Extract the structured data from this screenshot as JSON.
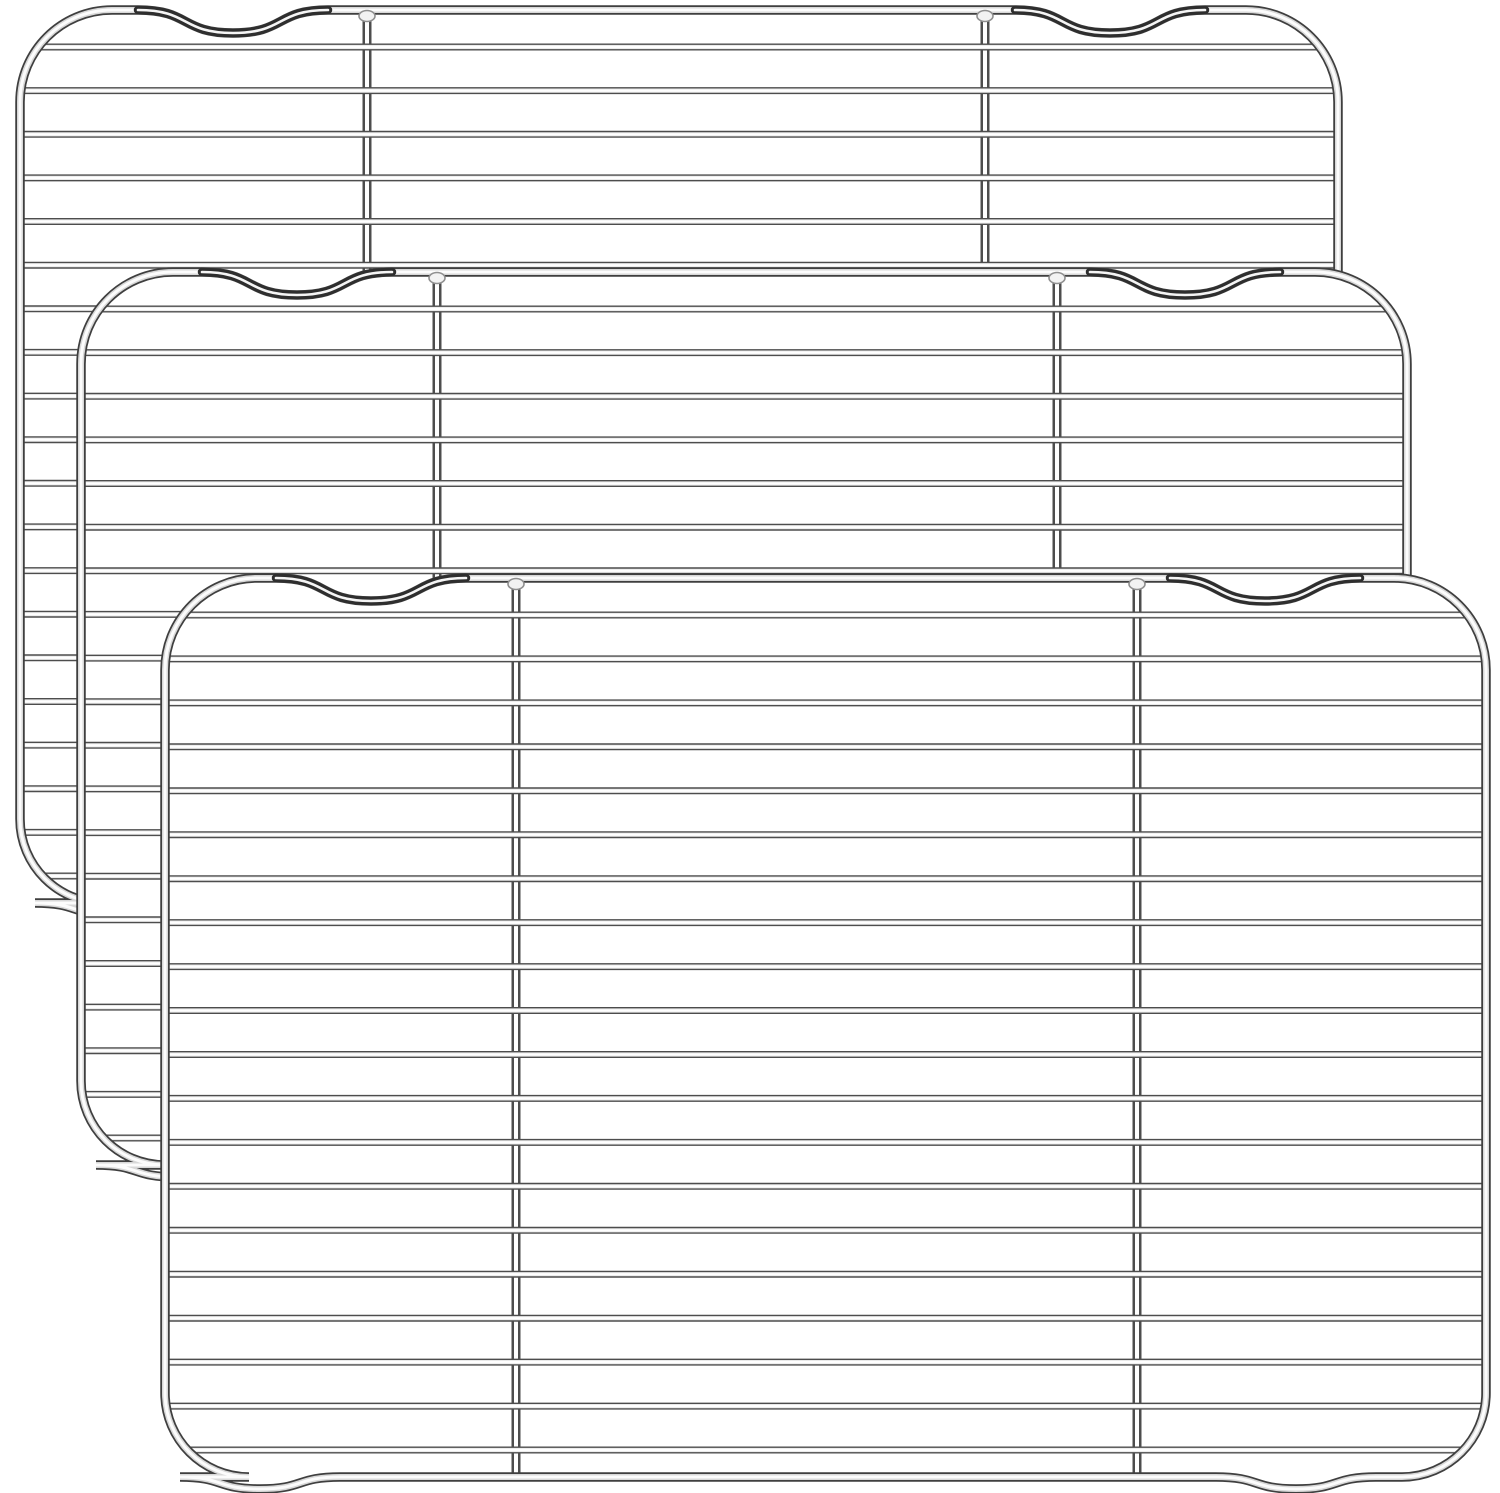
{
  "scene": {
    "description": "Product photo: set of 3 stainless steel wire cooling / baking racks, stacked overlapping diagonally from upper-left (back) to lower-right (front) on a plain white background",
    "background_color": "#ffffff",
    "item_count": 3
  },
  "style": {
    "wire_edge_color": "#4d4d4d",
    "wire_mid_color": "#e9e9e9",
    "wire_core_color": "#ffffff",
    "frame_edge_color": "#3f3f3f",
    "frame_mid_color": "#d8d8d8",
    "frame_core_color": "#fcfcfc",
    "notch_edge_color": "#2e2e2e",
    "notch_core_color": "#f5f5f5",
    "weld_fill_color": "#f2f2f2",
    "weld_stroke_color": "#8f8f8f",
    "frame_stroke_width": 9.5,
    "frame_mid_width": 6,
    "frame_core_width": 3,
    "wire_stroke_width": 7,
    "wire_mid_width": 4.2,
    "wire_core_width": 2.2,
    "vertical_stroke_width": 9,
    "vertical_core_width": 4,
    "corner_radius_top": 92,
    "corner_radius_bottom": 84,
    "notch_half_width": 95,
    "notch_depth": 23,
    "foot_half_width": 80,
    "foot_depth": 12,
    "wire_count": 20,
    "first_wire_offset": 37,
    "last_wire_offset": 27
  },
  "racks": [
    {
      "name": "rack-back",
      "left": 20,
      "top": 10,
      "right": 1338,
      "bottom": 903,
      "verticals": [
        367,
        985
      ],
      "notch_centers": [
        233,
        1110
      ],
      "foot_centers": [
        115,
        1148
      ]
    },
    {
      "name": "rack-middle",
      "left": 81,
      "top": 272,
      "right": 1407,
      "bottom": 1165,
      "verticals": [
        437,
        1057
      ],
      "notch_centers": [
        297,
        1185
      ],
      "foot_centers": [
        176,
        1217
      ]
    },
    {
      "name": "rack-front",
      "left": 165,
      "top": 578,
      "right": 1486,
      "bottom": 1477,
      "verticals": [
        516,
        1137
      ],
      "notch_centers": [
        371,
        1265
      ],
      "foot_centers": [
        260,
        1296
      ]
    }
  ]
}
